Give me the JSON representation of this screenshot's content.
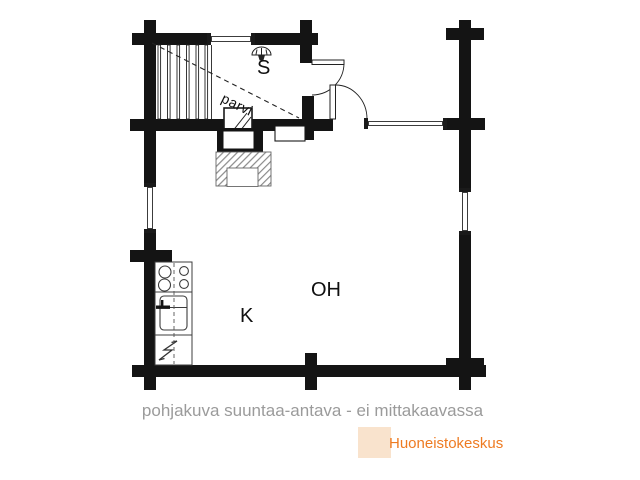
{
  "plan": {
    "rooms": {
      "sauna_label": "S",
      "loft_label": "parvi",
      "kitchen_label": "K",
      "living_room_label": "OH"
    },
    "icons": {
      "shower": "shower-head",
      "sauna_stove": "hatched-square",
      "fireplace": "hatched-masonry-block",
      "stove_burners": "four-circles",
      "sink": "rounded-basin-with-faucet",
      "fridge": "lightning-bolt",
      "stairs": "parallel-tread-lines",
      "doors": "quarter-arc-swing"
    },
    "colors": {
      "wall": "#141414",
      "hatch": "#8a8a8a"
    }
  },
  "caption": {
    "text": "pohjakuva suuntaa-antava - ei mittakaavassa",
    "color": "#9b9b9b"
  },
  "logo": {
    "text": "Huoneistokeskus",
    "color": "#ee7b22",
    "highlight_color": "#f9e3cd"
  }
}
